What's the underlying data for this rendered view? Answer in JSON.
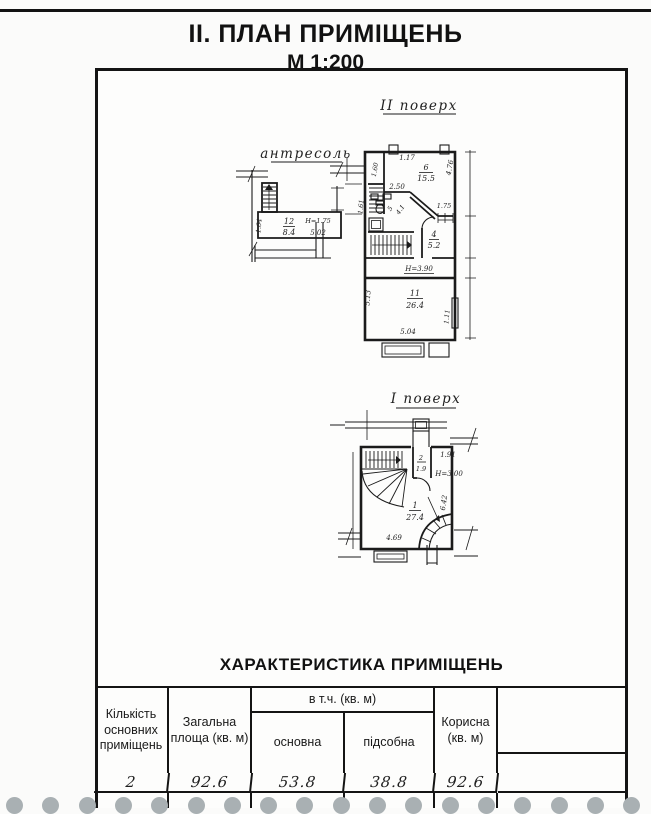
{
  "page": {
    "title": "II. ПЛАН ПРИМІЩЕНЬ",
    "scale": "М 1:200"
  },
  "plans": {
    "mezzanine": {
      "title": "антресоль",
      "room_num": "12",
      "room_area": "8.4",
      "height_mark": "Н=1.75",
      "dim_width": "5.02",
      "dim_left": "1.64"
    },
    "floor2": {
      "title": "ІІ поверх",
      "room6_num": "6",
      "room6_area": "15.5",
      "room5_num": "5",
      "room5_area": "4.1",
      "room4_num": "4",
      "room4_area": "5.2",
      "room11_num": "11",
      "room11_area": "26.4",
      "dim_117": "1.17",
      "dim_160": "1.60",
      "dim_476": "4.76",
      "dim_250": "2.50",
      "dim_161": "1.61",
      "dim_175": "1.75",
      "height_mark": "Н=3.90",
      "dim_513": "5.13",
      "dim_504": "5.04",
      "dim_111": "1.11"
    },
    "floor1": {
      "title": "І поверх",
      "room1_num": "1",
      "room1_area": "27.4",
      "room2_num": "2",
      "room2_area": "1.9",
      "dim_191": "1.91",
      "height_mark": "Н=3.00",
      "dim_642": "6.42",
      "dim_469": "4.69"
    }
  },
  "table": {
    "title": "ХАРАКТЕРИСТИКА ПРИМІЩЕНЬ",
    "headers": {
      "count": "Кількість основних приміщень",
      "total": "Загальна площа (кв. м)",
      "incl": "в т.ч. (кв. м)",
      "main": "основна",
      "aux": "підсобна",
      "useful": "Корисна (кв. м)"
    },
    "row": {
      "count": "2",
      "total": "92.6",
      "main": "53.8",
      "aux": "38.8",
      "useful": "92.6"
    }
  }
}
